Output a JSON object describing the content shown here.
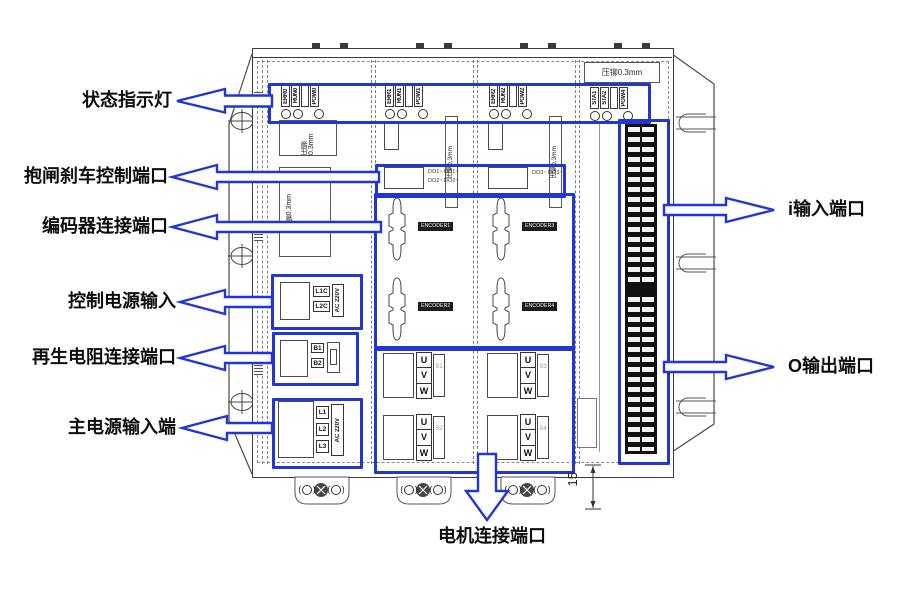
{
  "callouts": {
    "status": "状态指示灯",
    "brake": "抱闸刹车控制端口",
    "encoder": "编码器连接端口",
    "control_power": "控制电源输入",
    "regen": "再生电阻连接端口",
    "main_power": "主电源输入端",
    "io_input": "i输入端口",
    "io_output": "O输出端口",
    "motor": "电机连接端口"
  },
  "dim_15": "15",
  "uvw": [
    "U",
    "V",
    "W"
  ],
  "notes": {
    "p1a": "压铆 0.3mm",
    "p1b": "压铆0.3mm",
    "p2": "压铆0.3mm",
    "p3": "压铆0.3mm",
    "p4": "压铆0.3mm"
  },
  "leds": {
    "p1": [
      "ERR0",
      "RUN0",
      "POW0"
    ],
    "p2": [
      "ERR1",
      "RUN1",
      "POW1"
    ],
    "p3": [
      "ERR2",
      "RUN2",
      "POW2"
    ],
    "p4": [
      "STA1",
      "STA2",
      "POW4"
    ]
  },
  "power": {
    "control": {
      "t1": "L1C",
      "t2": "L2C",
      "rating": "AC 220V"
    },
    "regen": {
      "t1": "B1",
      "t2": "B2"
    },
    "main": {
      "t1": "L1",
      "t2": "L2",
      "t3": "L3",
      "rating": "AC 220V"
    }
  },
  "do_ports": {
    "p2_line1": "DO1~ DO1~",
    "p2_line2": "DO2~ DO2~",
    "p3_line1": "DO3~ DO3~"
  },
  "encoders": [
    "ENCODER1",
    "ENCODER2",
    "ENCODER3",
    "ENCODER4"
  ],
  "servo": [
    "S1",
    "S2",
    "S3",
    "S4"
  ],
  "colors": {
    "accent": "#2136d4",
    "line": "#3c3c3c"
  }
}
